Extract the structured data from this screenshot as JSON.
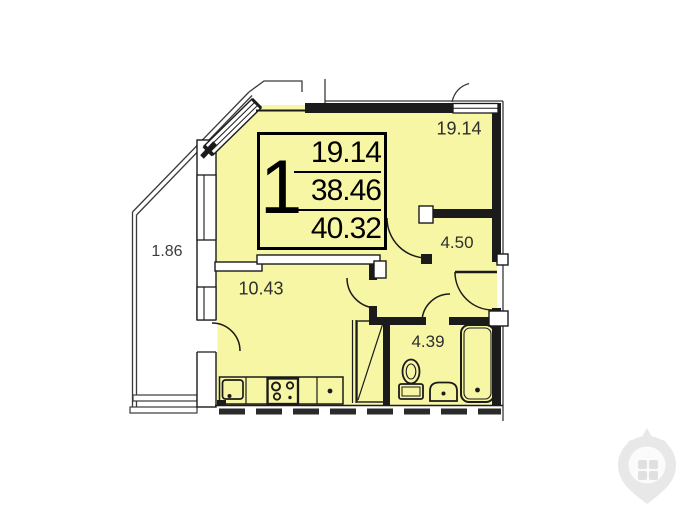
{
  "floor_plan": {
    "info_box": {
      "rooms_count": "1",
      "line1": "19.14",
      "line2": "38.46",
      "line3": "40.32"
    },
    "rooms": {
      "living_room_area": "19.14",
      "hallway_area": "4.50",
      "kitchen_area": "10.43",
      "bathroom_area": "4.39",
      "balcony_area": "1.86"
    },
    "colors": {
      "apartment_fill": "#f6f6a4",
      "wall": "#1b1b1b",
      "thin_line": "#3a3a3a",
      "label_text": "#2e2e2e",
      "watermark": "#e8e8e8"
    }
  }
}
